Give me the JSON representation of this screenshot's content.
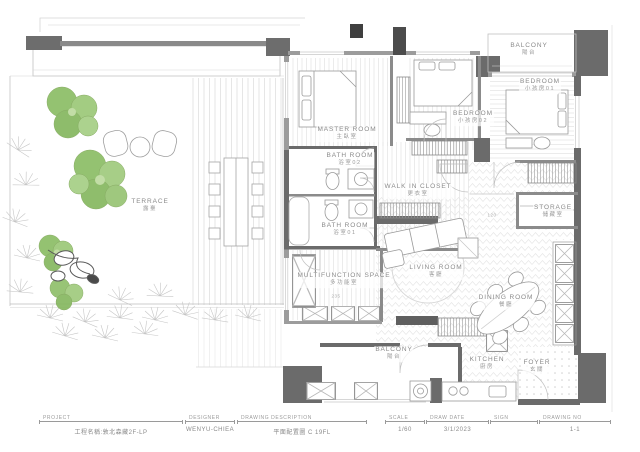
{
  "rooms": {
    "terrace": {
      "en": "TERRACE",
      "zh": "露臺"
    },
    "master": {
      "en": "MASTER ROOM",
      "zh": "主臥室"
    },
    "bath02": {
      "en": "BATH ROOM",
      "zh": "浴室02"
    },
    "bath01": {
      "en": "BATH ROOM",
      "zh": "浴室01"
    },
    "walkin": {
      "en": "WALK IN CLOSET",
      "zh": "更衣室"
    },
    "bedroom02": {
      "en": "BEDROOM",
      "zh": "小孩房02"
    },
    "bedroom01": {
      "en": "BEDROOM",
      "zh": "小孩房01"
    },
    "balcony_top": {
      "en": "BALCONY",
      "zh": "陽台"
    },
    "storage": {
      "en": "STORAGE",
      "zh": "儲藏室"
    },
    "living": {
      "en": "LIVING ROOM",
      "zh": "客廳"
    },
    "dining": {
      "en": "DINING ROOM",
      "zh": "餐廳"
    },
    "multifunction": {
      "en": "MULTIFUNCTION SPACE",
      "zh": "多功能室"
    },
    "balcony_bottom": {
      "en": "BALCONY",
      "zh": "陽台"
    },
    "kitchen": {
      "en": "KITCHEN",
      "zh": "廚房"
    },
    "foyer": {
      "en": "FOYER",
      "zh": "玄關"
    }
  },
  "annotations": {
    "dim1": "120",
    "dim2": "235"
  },
  "titleblock": {
    "fields": [
      {
        "label": "PROJECT",
        "value": "工程名稱:敦北森藏2F-LP"
      },
      {
        "label": "DESIGNER",
        "value": "WENYU-CHIEA"
      },
      {
        "label": "DRAWING DESCRIPTION",
        "value": "平面配置圖 C 19FL"
      },
      {
        "label": "SCALE",
        "value": "1/60"
      },
      {
        "label": "DRAW DATE",
        "value": "3/1/2023"
      },
      {
        "label": "SIGN",
        "value": ""
      },
      {
        "label": "DRAWING NO",
        "value": "1-1"
      }
    ]
  },
  "colors": {
    "wall": "#6b6b6b",
    "tree_green": "#8cbd66",
    "label_gray": "#8a8a8a"
  }
}
